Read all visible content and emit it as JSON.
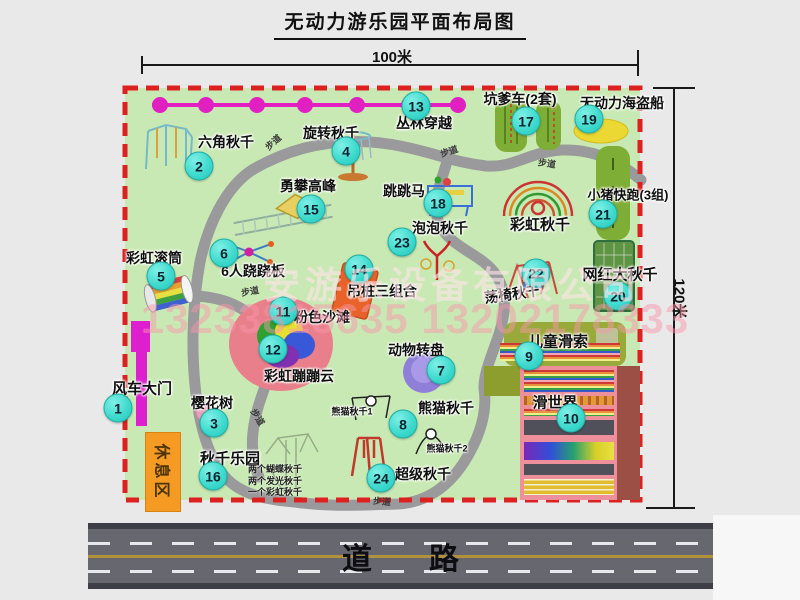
{
  "title": "无动力游乐园平面布局图",
  "dimensions": {
    "width_label": "100米",
    "height_label": "120米"
  },
  "road": {
    "label": "道路"
  },
  "watermark": {
    "line1": "安游乐设备有限公司",
    "line2": "13233815635 13202178333"
  },
  "rest_area": {
    "label": "休息区"
  },
  "path_label": "步道",
  "colors": {
    "park_green": "#c9e9b4",
    "border_red": "#dd2020",
    "badge_teal": "#3bd8cc",
    "gate_magenta": "#dd1fd0",
    "rest_orange": "#f59a23",
    "road_gray": "#67676f"
  },
  "map": {
    "items": [
      {
        "num": "1",
        "label": "风车大门",
        "badge": [
          118,
          408
        ],
        "lab": [
          142,
          388
        ],
        "fs": 15
      },
      {
        "num": "2",
        "label": "六角秋千",
        "badge": [
          199,
          166
        ],
        "lab": [
          226,
          142
        ]
      },
      {
        "num": "3",
        "label": "樱花树",
        "badge": [
          214,
          423
        ],
        "lab": [
          212,
          403
        ]
      },
      {
        "num": "4",
        "label": "旋转秋千",
        "badge": [
          346,
          151
        ],
        "lab": [
          331,
          133
        ]
      },
      {
        "num": "5",
        "label": "彩虹滚筒",
        "badge": [
          161,
          276
        ],
        "lab": [
          154,
          258
        ]
      },
      {
        "num": "6",
        "label": "6人跷跷板",
        "badge": [
          224,
          253
        ],
        "lab": [
          253,
          271
        ]
      },
      {
        "num": "7",
        "label": "动物转盘",
        "badge": [
          441,
          370
        ],
        "lab": [
          416,
          350
        ]
      },
      {
        "num": "8",
        "label": "熊猫秋千",
        "badge": [
          403,
          424
        ],
        "lab": [
          446,
          408
        ]
      },
      {
        "num": "9",
        "label": "儿童滑索",
        "badge": [
          529,
          356
        ],
        "lab": [
          558,
          341
        ],
        "fs": 15
      },
      {
        "num": "10",
        "label": "滑世界",
        "badge": [
          571,
          418
        ],
        "lab": [
          555,
          402
        ],
        "fs": 15
      },
      {
        "num": "11",
        "label": "粉色沙滩",
        "badge": [
          283,
          311
        ],
        "lab": [
          322,
          317
        ]
      },
      {
        "num": "12",
        "label": "彩虹蹦蹦云",
        "badge": [
          273,
          349
        ],
        "lab": [
          299,
          376
        ]
      },
      {
        "num": "13",
        "label": "丛林穿越",
        "badge": [
          416,
          106
        ],
        "lab": [
          424,
          123
        ]
      },
      {
        "num": "14",
        "label": "吊桩三组合",
        "badge": [
          359,
          269
        ],
        "lab": [
          382,
          291
        ]
      },
      {
        "num": "15",
        "label": "勇攀高峰",
        "badge": [
          311,
          209
        ],
        "lab": [
          308,
          186
        ]
      },
      {
        "num": "16",
        "label": "秋千乐园",
        "badge": [
          213,
          476
        ],
        "lab": [
          230,
          458
        ],
        "fs": 15,
        "sub": [
          "两个蝴蝶秋千",
          "两个发光秋千",
          "一个彩虹秋千"
        ],
        "sub_pos": [
          248,
          462
        ]
      },
      {
        "num": "17",
        "label": "坑爹车(2套)",
        "badge": [
          526,
          121
        ],
        "lab": [
          520,
          99
        ]
      },
      {
        "num": "18",
        "label": "跳跳马",
        "badge": [
          438,
          203
        ],
        "lab": [
          404,
          191
        ]
      },
      {
        "num": "19",
        "label": "无动力海盗船",
        "badge": [
          589,
          119
        ],
        "lab": [
          622,
          103
        ]
      },
      {
        "num": "20",
        "label": "网红大秋千",
        "badge": [
          618,
          296
        ],
        "lab": [
          620,
          274
        ],
        "fs": 15
      },
      {
        "num": "21",
        "label": "小猪快跑(3组)",
        "badge": [
          603,
          214
        ],
        "lab": [
          628,
          194
        ],
        "fs": 13
      },
      {
        "num": "22",
        "label": "荡椅秋千",
        "badge": [
          536,
          273
        ],
        "lab": [
          512,
          294
        ],
        "rot": -8
      },
      {
        "num": "23",
        "label": "泡泡秋千",
        "badge": [
          402,
          242
        ],
        "lab": [
          440,
          228
        ]
      },
      {
        "num": "24",
        "label": "超级秋千",
        "badge": [
          381,
          478
        ],
        "lab": [
          423,
          474
        ]
      }
    ],
    "extra_labels": [
      {
        "text": "彩虹秋千",
        "x": 540,
        "y": 224,
        "fs": 15
      },
      {
        "text": "熊猫秋千1",
        "x": 352,
        "y": 411,
        "fs": 9
      },
      {
        "text": "熊猫秋千2",
        "x": 447,
        "y": 448,
        "fs": 9
      }
    ],
    "path_marks": [
      {
        "x": 273,
        "y": 142,
        "r": -42
      },
      {
        "x": 449,
        "y": 151,
        "r": -18
      },
      {
        "x": 547,
        "y": 163,
        "r": 8
      },
      {
        "x": 250,
        "y": 291,
        "r": -10
      },
      {
        "x": 258,
        "y": 417,
        "r": 58
      },
      {
        "x": 382,
        "y": 501,
        "r": 5
      }
    ]
  }
}
